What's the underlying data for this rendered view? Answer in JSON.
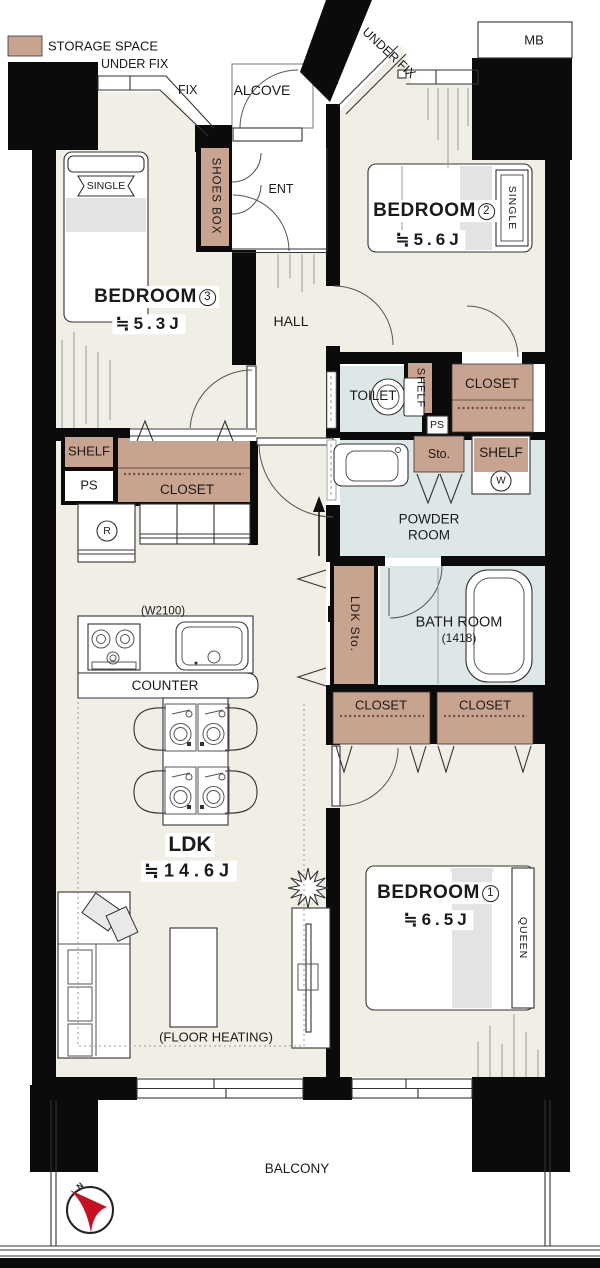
{
  "colors": {
    "storage": "#C8A38F",
    "wet": "#DDE7E7",
    "floor": "#F1EEE6",
    "wall": "#0B0B0B",
    "accent_red": "#C81022"
  },
  "legend": {
    "label": "STORAGE SPACE"
  },
  "exterior": {
    "under_fix_left": "UNDER FIX",
    "fix": "FIX",
    "alcove": "ALCOVE",
    "under_fix_right": "UNDER FIX",
    "mb": "MB",
    "balcony": "BALCONY",
    "compass_north": "N"
  },
  "entrance": {
    "shoes_box": "SHOES BOX",
    "ent": "ENT",
    "hall": "HALL"
  },
  "rooms": {
    "bedroom1": {
      "name": "BEDROOM",
      "number": "1",
      "size": "≒6.5J",
      "bed": "QUEEN"
    },
    "bedroom2": {
      "name": "BEDROOM",
      "number": "2",
      "size": "≒5.6J",
      "bed": "SINGLE"
    },
    "bedroom3": {
      "name": "BEDROOM",
      "number": "3",
      "size": "≒5.3J",
      "bed": "SINGLE"
    },
    "ldk": {
      "name": "LDK",
      "size": "≒14.6J",
      "floor_heating": "(FLOOR HEATING)",
      "counter": "COUNTER",
      "kitchen_width": "(W2100)",
      "fridge": "R"
    },
    "toilet": {
      "name": "TOILET",
      "shelf": "SHELF",
      "ps": "PS"
    },
    "powder": {
      "name": "POWDER ROOM",
      "sto": "Sto.",
      "shelf": "SHELF",
      "washer": "W"
    },
    "bath": {
      "name": "BATH ROOM",
      "size": "(1418)",
      "ldk_sto": "LDK Sto."
    }
  },
  "storage": {
    "shelf_left": "SHELF",
    "ps_left": "PS",
    "closet_left": "CLOSET",
    "closet_bedroom2": "CLOSET",
    "closet_south_1": "CLOSET",
    "closet_south_2": "CLOSET"
  }
}
